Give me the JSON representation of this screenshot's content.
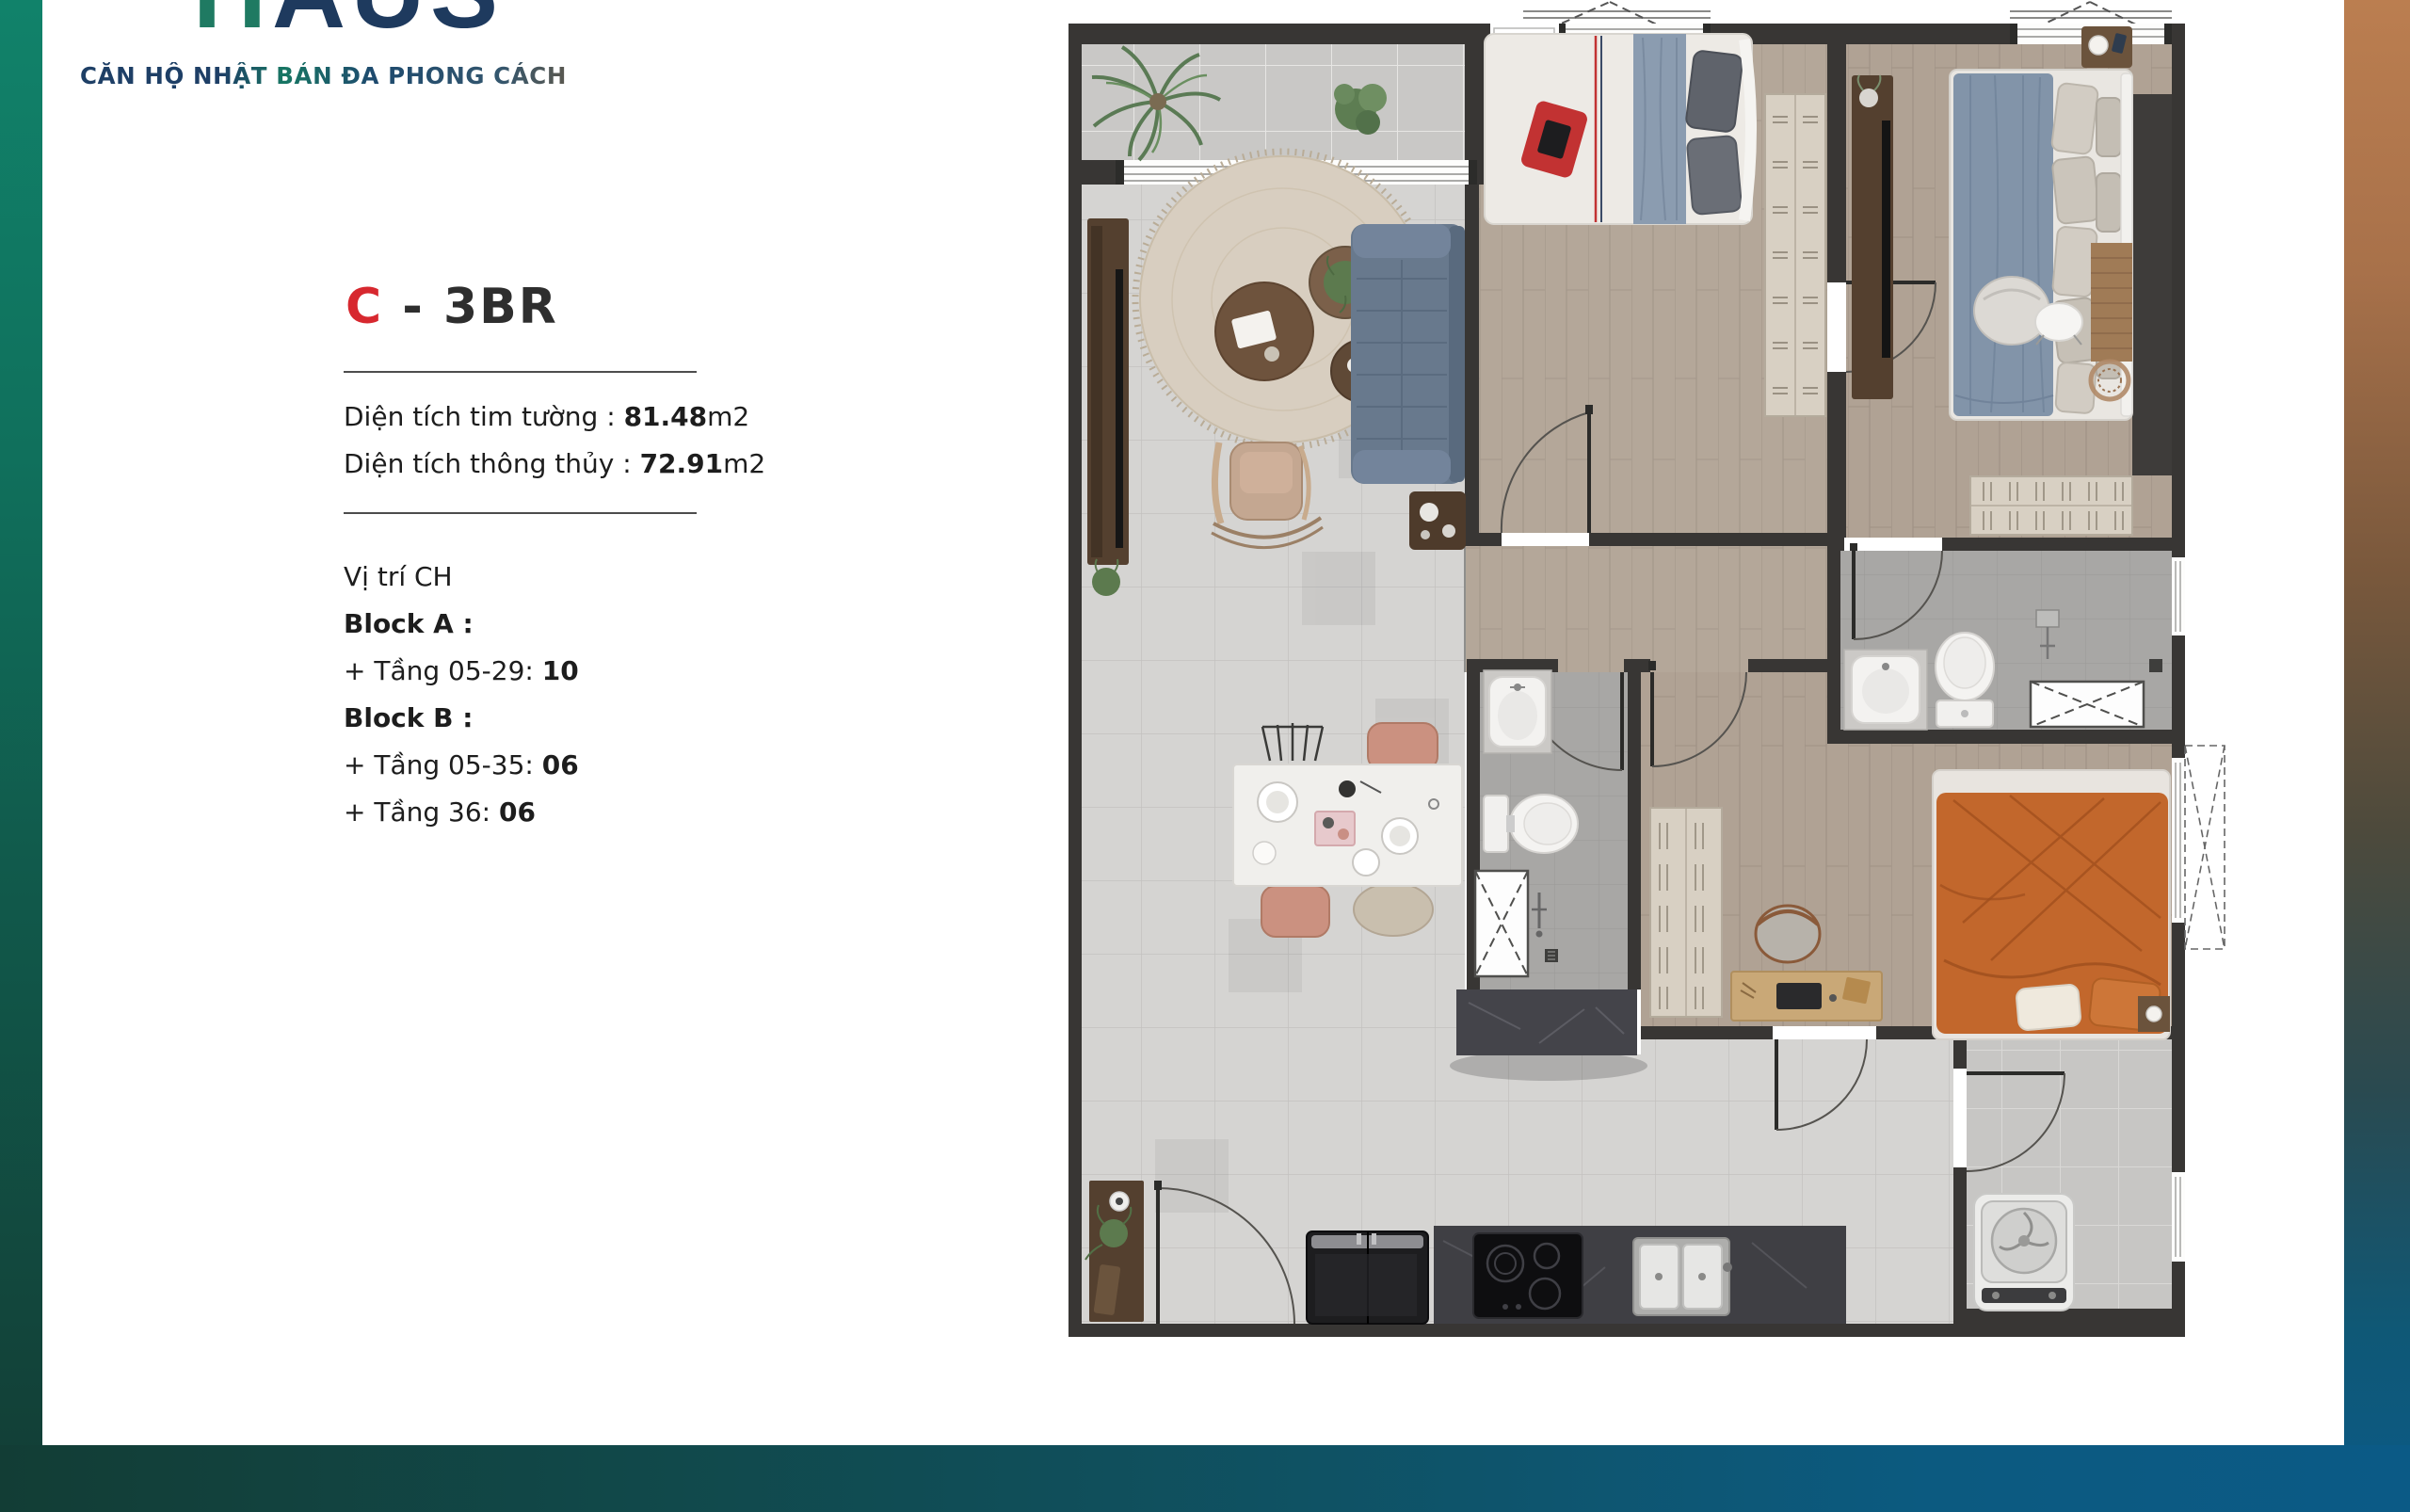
{
  "brand": {
    "logo_text_first": "H",
    "logo_text_rest": "AUS",
    "tagline": "CĂN HỘ NHẬT BẢN ĐA PHONG CÁCH"
  },
  "unit": {
    "code": "C",
    "name_suffix": "- 3BR",
    "areas": [
      {
        "label": "Diện tích tim tường : ",
        "value": "81.48",
        "unit": "m2"
      },
      {
        "label": "Diện tích thông thủy : ",
        "value": "72.91",
        "unit": "m2"
      }
    ],
    "location": [
      {
        "prefix": "Vị trí CH",
        "value": ""
      },
      {
        "prefix": "Block A :",
        "value": ""
      },
      {
        "prefix": "+ Tầng 05-29: ",
        "value": "10"
      },
      {
        "prefix": "Block B :",
        "value": ""
      },
      {
        "prefix": "+ Tầng 05-35: ",
        "value": "06"
      },
      {
        "prefix": "+ Tầng 36: ",
        "value": "06"
      }
    ]
  },
  "floorplan": {
    "rooms": [
      "Balcony",
      "Living room",
      "Dining area",
      "Kitchen",
      "Entry hall",
      "Bedroom 1",
      "Bedroom 2",
      "Bedroom 3",
      "Bathroom 1",
      "Bathroom 2",
      "Laundry"
    ]
  },
  "colors": {
    "accent_red": "#d7282f",
    "left_bar_top": "#11826a",
    "left_bar_bottom": "#123d35",
    "bottom_bar_left": "#123d35",
    "bottom_bar_right": "#0b5a86",
    "right_bar_top": "#bb7e50",
    "right_bar_bottom": "#0b5a86",
    "wall": "#383634"
  }
}
